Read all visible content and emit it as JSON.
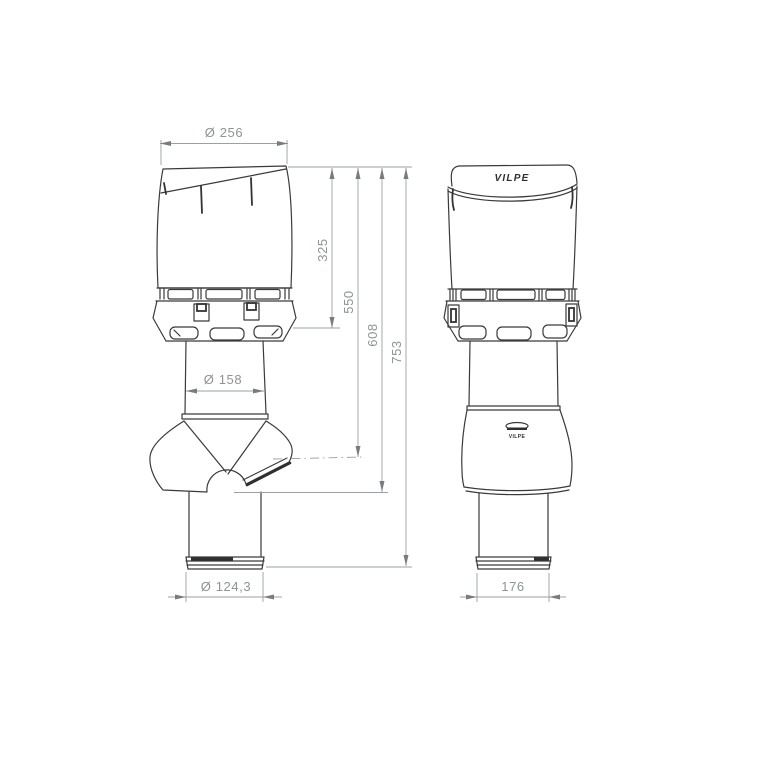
{
  "drawing": {
    "brand": {
      "cap_logo": "VILPE",
      "pipe_logo": "VILPE"
    },
    "dimensions": {
      "cap_diameter": "Ø 256",
      "cap_height": "325",
      "height_to_outlet": "550",
      "height_to_skirt": "608",
      "total_height": "753",
      "pipe_diameter": "Ø 158",
      "bottom_pipe_diameter": "Ø 124,3",
      "front_pipe_width": "176"
    },
    "colors": {
      "object_line": "#3a3a3a",
      "dimension_line": "#9aa0a3",
      "dimension_text": "#8d9396",
      "background": "#ffffff"
    }
  }
}
